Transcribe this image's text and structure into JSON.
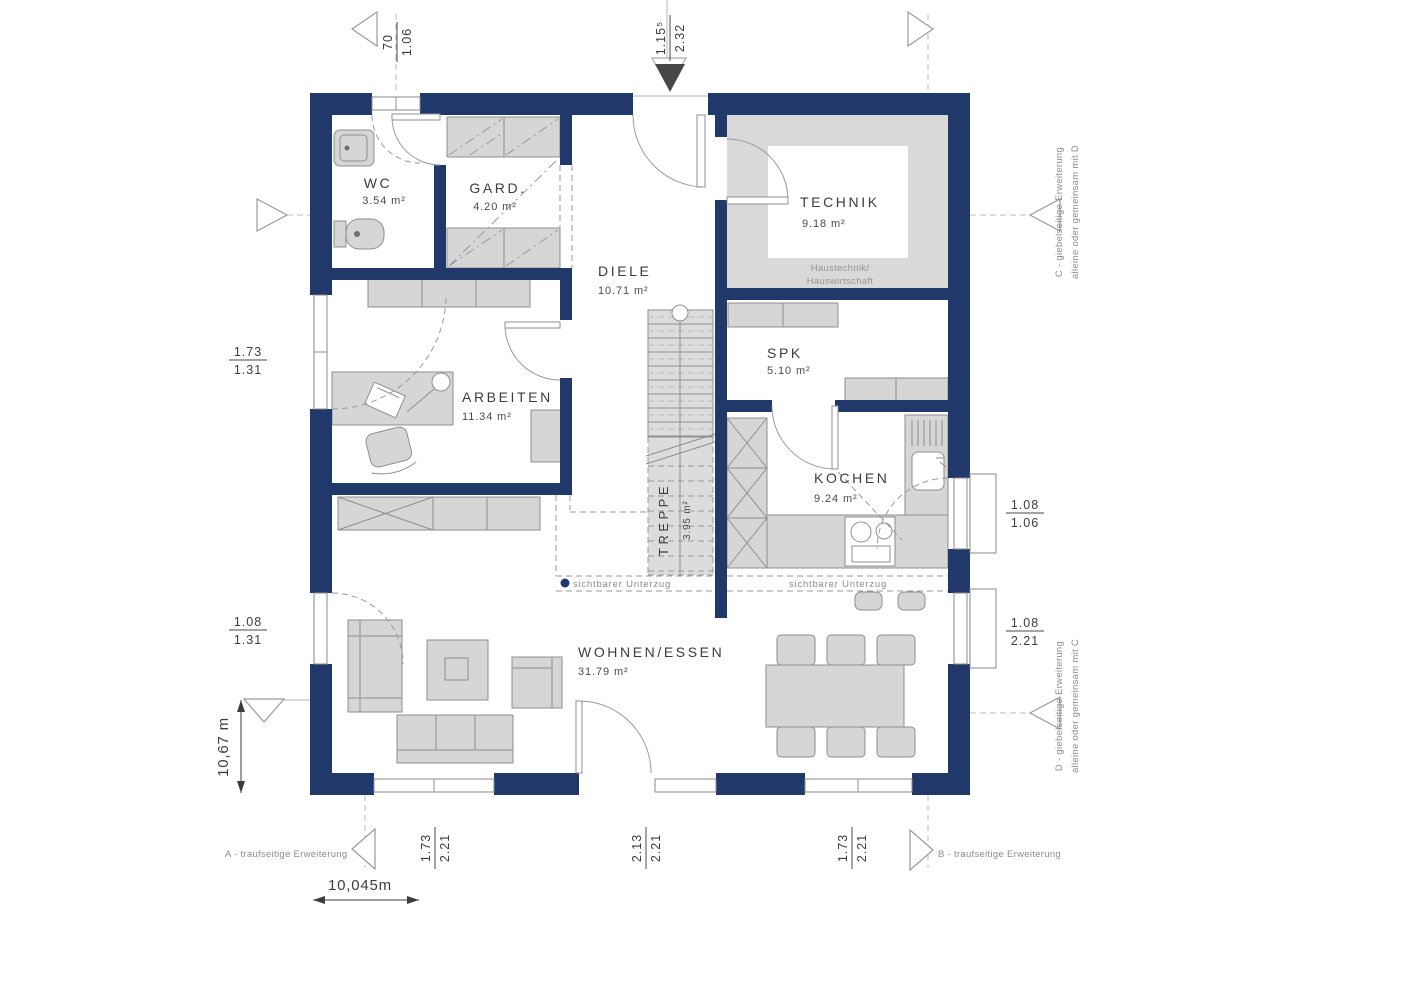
{
  "colors": {
    "wall": "#21386b",
    "furniture_fill": "#d6d6d6",
    "furniture_stroke": "#8f8f8f",
    "floor_gray": "#d9d9d9",
    "text_dark": "#3d3d3d",
    "text_gray": "#8c8c8c"
  },
  "rooms": {
    "wc": {
      "name": "WC",
      "area": "3.54 m²"
    },
    "gard": {
      "name": "GARD.",
      "area": "4.20 m²"
    },
    "diele": {
      "name": "DIELE",
      "area": "10.71 m²"
    },
    "technik": {
      "name": "TECHNIK",
      "area": "9.18 m²",
      "note_line1": "Haustechnik/",
      "note_line2": "Hauswirtschaft"
    },
    "spk": {
      "name": "SPK",
      "area": "5.10 m²"
    },
    "arbeiten": {
      "name": "ARBEITEN",
      "area": "11.34 m²"
    },
    "kochen": {
      "name": "KOCHEN",
      "area": "9.24 m²"
    },
    "treppe": {
      "name": "TREPPE",
      "area": "3.95 m²"
    },
    "wohnen": {
      "name": "WOHNEN/ESSEN",
      "area": "31.79 m²"
    }
  },
  "dimensions": {
    "top_left": {
      "top": "70",
      "bottom": "1.06"
    },
    "top_center": {
      "top": "1.15⁵",
      "bottom": "2.32"
    },
    "left_upper": {
      "top": "1.73",
      "bottom": "1.31"
    },
    "left_lower": {
      "top": "1.08",
      "bottom": "1.31"
    },
    "right_upper": {
      "top": "1.08",
      "bottom": "1.06"
    },
    "right_lower": {
      "top": "1.08",
      "bottom": "2.21"
    },
    "bottom_left": {
      "top": "1.73",
      "bottom": "2.21"
    },
    "bottom_center": {
      "top": "2.13",
      "bottom": "2.21"
    },
    "bottom_right": {
      "top": "1.73",
      "bottom": "2.21"
    },
    "overall_width": "10,045m",
    "overall_height": "10,67 m"
  },
  "annotations": {
    "ext_a": "A - traufseitige Erweiterung",
    "ext_b": "B - traufseitige Erweiterung",
    "ext_c_line1": "C - giebelseitige Erweiterung",
    "ext_c_line2": "alleine oder gemeinsam mit D",
    "ext_d_line1": "D - giebelseitige Erweiterung",
    "ext_d_line2": "alleine oder gemeinsam mit C",
    "unterzug_left": "sichtbarer Unterzug",
    "unterzug_right": "sichtbarer Unterzug"
  }
}
